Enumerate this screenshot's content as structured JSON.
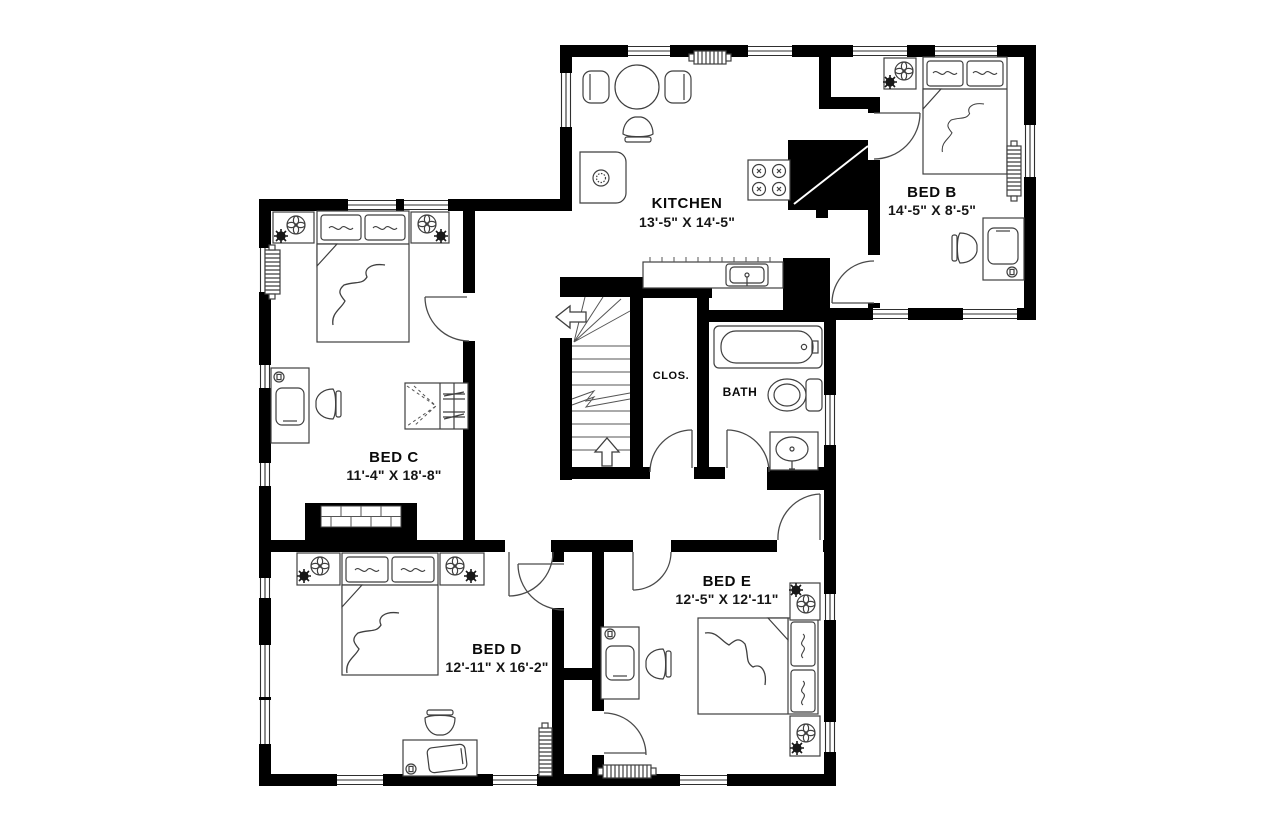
{
  "plan_title": "Upper floor plan",
  "colors": {
    "wall": "#000000",
    "furniture_line": "#3f3f3f",
    "background": "#ffffff",
    "text": "#0a0a0a"
  },
  "rooms": {
    "kitchen": {
      "name": "KITCHEN",
      "dims": "13'-5\" X 14'-5\""
    },
    "bed_b": {
      "name": "BED B",
      "dims": "14'-5\" X 8'-5\""
    },
    "bed_c": {
      "name": "BED C",
      "dims": "11'-4\" X 18'-8\""
    },
    "bed_d": {
      "name": "BED D",
      "dims": "12'-11\" X 16'-2\""
    },
    "bed_e": {
      "name": "BED E",
      "dims": "12'-5\" X 12'-11\""
    },
    "closet": {
      "name": "CLOS."
    },
    "bath": {
      "name": "BATH"
    }
  },
  "furniture": {
    "kitchen": [
      "round-dining-table",
      "dining-chairs",
      "refrigerator",
      "stove",
      "counter-with-sink",
      "vent-grille"
    ],
    "bed_b": [
      "double-bed",
      "nightstand",
      "plant",
      "radiator",
      "desk-with-chair",
      "outlet"
    ],
    "bed_c": [
      "double-bed",
      "nightstands",
      "plants",
      "radiator",
      "desk-with-chair",
      "closet-bifold",
      "fireplace"
    ],
    "bed_d": [
      "double-bed",
      "nightstands",
      "plants",
      "desk-with-chair",
      "radiator",
      "outlet"
    ],
    "bed_e": [
      "double-bed",
      "nightstands",
      "plants",
      "desk-with-chair",
      "radiator",
      "outlet"
    ],
    "bath": [
      "bathtub",
      "toilet",
      "sink"
    ],
    "stairs": [
      "up-arrow",
      "winder-steps",
      "break-line"
    ]
  }
}
